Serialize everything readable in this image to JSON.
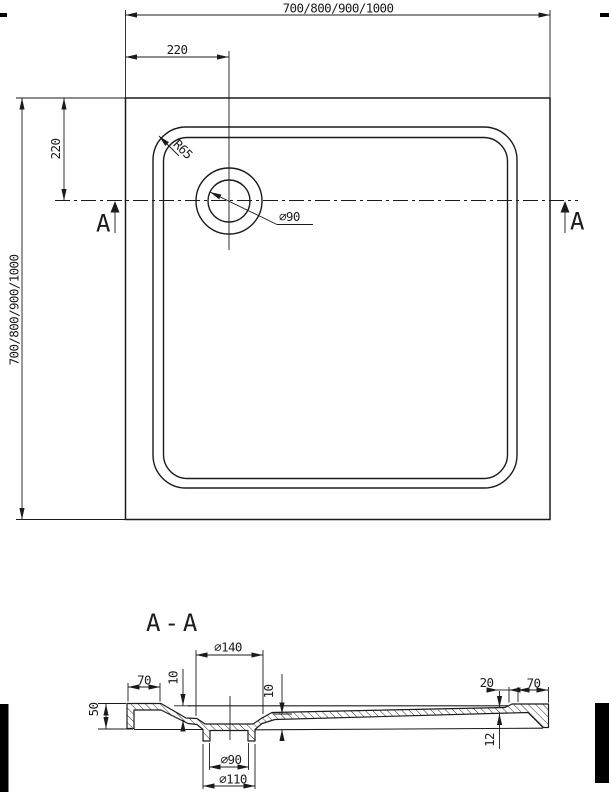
{
  "colors": {
    "line": "#1b1b1b",
    "background": "#ffffff",
    "artifact": "#000000"
  },
  "top_view": {
    "width_label": "700/800/900/1000",
    "height_label": "700/800/900/1000",
    "drain_offset_horizontal": "220",
    "drain_offset_vertical": "220",
    "corner_radius_label": "R65",
    "drain_diameter_label": "⌀90",
    "section_cut_label_left": "A",
    "section_cut_label_right": "A"
  },
  "section_view": {
    "title": "A-A",
    "flange_diameter": "⌀140",
    "left_rim_width": "70",
    "right_rim_width": "70",
    "left_depth": "10",
    "right_depth": "10",
    "right_step_width": "20",
    "left_height": "50",
    "right_thickness": "12",
    "drain_bore_diameter": "⌀90",
    "drain_spigot_diameter": "⌀110"
  }
}
